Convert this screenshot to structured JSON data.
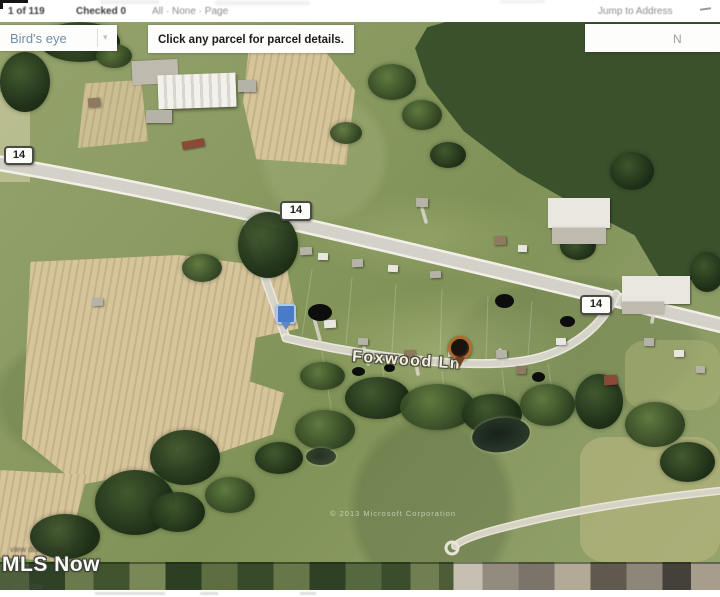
{
  "toolbar": {
    "pagination": "1 of 119",
    "checked_count": "Checked 0",
    "selection_links": "All · None · Page",
    "jump_to_address": "Jump to Address"
  },
  "map": {
    "view_mode": "Bird's eye",
    "instruction": "Click any parcel for parcel details.",
    "compass": "N",
    "shields": [
      "14",
      "14",
      "14"
    ],
    "street_label": "Foxwood Ln",
    "copyright": "© 2013 Microsoft Corporation"
  },
  "branding": {
    "disclaimer": "view disclaimer",
    "logo": "MLS Now",
    "logo_small": "MLS Now"
  },
  "colors": {
    "map_grass": "#8b9b63",
    "field_tan": "#d6c49b",
    "forest_green": "#3a512c",
    "road_gray": "#d4d2c8",
    "pin_blue": "#4a7bc8",
    "pin_orange": "#b06a2a",
    "birdseye_text": "#6f8fa8",
    "toolbar_link_gray": "#8d8d8d"
  }
}
